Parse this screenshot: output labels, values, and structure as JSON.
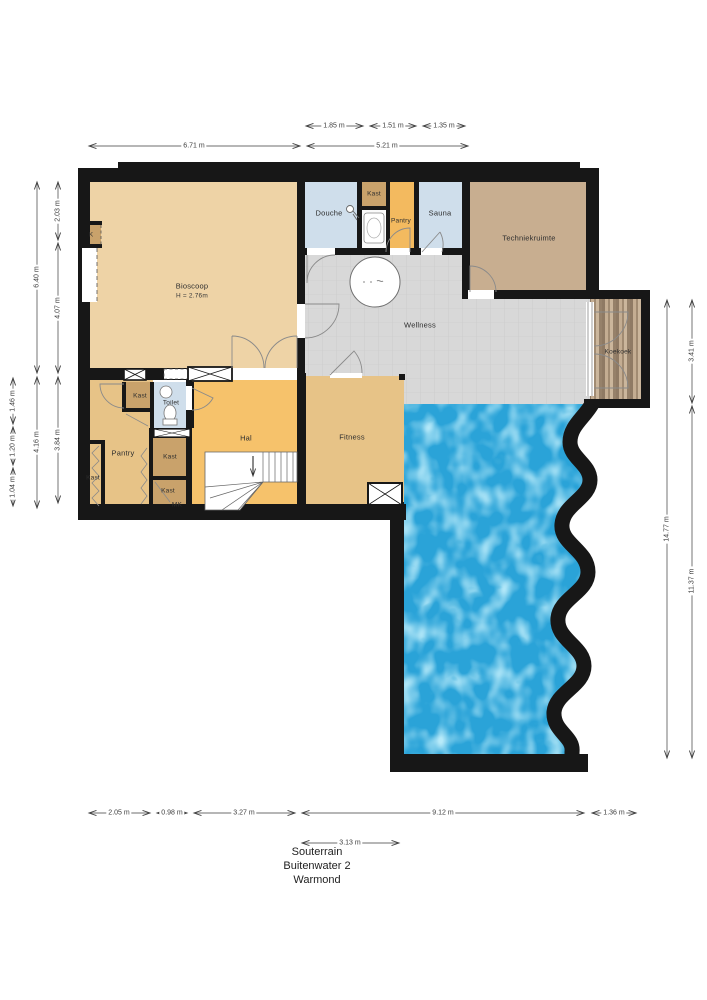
{
  "title": {
    "line1": "Souterrain",
    "line2": "Buitenwater 2",
    "line3": "Warmond"
  },
  "rooms": {
    "bioscoop": {
      "label": "Bioscoop",
      "height_note": "H = 2.76m"
    },
    "k_closet": {
      "label": "K"
    },
    "douche": {
      "label": "Douche"
    },
    "kast_top": {
      "label": "Kast"
    },
    "pantry_top": {
      "label": "Pantry"
    },
    "sauna": {
      "label": "Sauna"
    },
    "techniekruimte": {
      "label": "Techniekruimte"
    },
    "wellness": {
      "label": "Wellness"
    },
    "koekoek": {
      "label": "Koekoek"
    },
    "kast_a": {
      "label": "Kast"
    },
    "toilet": {
      "label": "Toilet"
    },
    "pantry_bottom": {
      "label": "Pantry"
    },
    "kast_b": {
      "label": "Kast"
    },
    "kast_c": {
      "label": "Kast"
    },
    "kast_d": {
      "label": "Kast"
    },
    "mk": {
      "label": "MK"
    },
    "hal": {
      "label": "Hal"
    },
    "fitness": {
      "label": "Fitness"
    }
  },
  "dimensions": {
    "top1": [
      {
        "label": "1.85 m"
      },
      {
        "label": "1.51 m"
      },
      {
        "label": "1.35 m"
      }
    ],
    "top2": [
      {
        "label": "6.71 m"
      },
      {
        "label": "5.21 m"
      }
    ],
    "left_outer": [
      {
        "label": "1.46 m"
      },
      {
        "label": "1.20 m"
      },
      {
        "label": "1.04 m"
      }
    ],
    "left_mid": [
      {
        "label": "6.40 m"
      },
      {
        "label": "4.16 m"
      }
    ],
    "left_inner": [
      {
        "label": "2.03 m"
      },
      {
        "label": "4.07 m"
      },
      {
        "label": "3.84 m"
      }
    ],
    "right_inner": [
      {
        "label": "14.77 m"
      }
    ],
    "right_outer": [
      {
        "label": "3.41 m"
      },
      {
        "label": "11.37 m"
      }
    ],
    "bottom1": [
      {
        "label": "2.05 m"
      },
      {
        "label": "0.98 m"
      },
      {
        "label": "3.27 m"
      },
      {
        "label": "9.12 m"
      },
      {
        "label": "1.36 m"
      }
    ],
    "bottom2": [
      {
        "label": "3.13 m"
      }
    ]
  },
  "colors": {
    "wall": "#171717",
    "bioscoop": "#eed3a6",
    "orange": "#f3ba5f",
    "hal": "#f6c26b",
    "tan": "#e7c387",
    "brown": "#c9a26b",
    "blue": "#cfdeeb",
    "tech": "#c8ae90",
    "wellness": "#d8d8d8",
    "pool": "#2aa3d8",
    "wood": "#b29a80"
  }
}
